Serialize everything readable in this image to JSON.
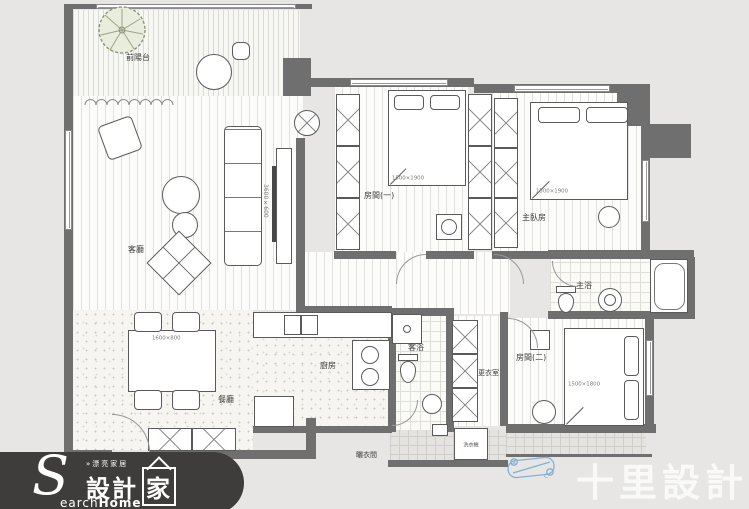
{
  "brand": {
    "tagline": "»漂亮家居",
    "zh_a": "設計",
    "zh_b": "家",
    "en_s": "S",
    "en_a": "earch",
    "en_b": "Home"
  },
  "studio": {
    "name": "十里設計"
  },
  "rooms": {
    "balcony": "前陽台",
    "living": "客廳",
    "room1": "房間(一)",
    "master": "主臥房",
    "master_bath": "主浴",
    "room2": "房間(二)",
    "closet": "更衣室",
    "guest_bath": "客浴",
    "kitchen": "廚房",
    "dining": "餐廳",
    "laundry": "曬衣間",
    "washer": "洗衣機"
  },
  "dims": {
    "room1_bed": "1500×1900",
    "master_bed": "1500×1900",
    "room2_bed": "1500×1800",
    "dining_table": "1600×800",
    "tv_cabinet": "3600×600"
  },
  "scooter": {
    "mark_a": "A",
    "mark_b": "C"
  },
  "colors": {
    "wall": "#6f6f6f",
    "logo_bg": "#3e3d3b",
    "scooter_blue": "#7fb3d6",
    "watermark": "#ffffff"
  }
}
